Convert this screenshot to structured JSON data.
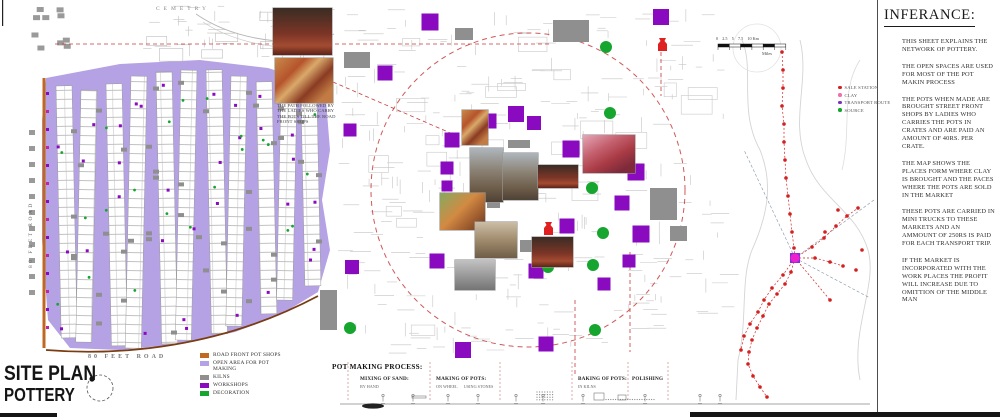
{
  "sheet_title": {
    "line1": "SITE PLAN",
    "line2": "POTTERY"
  },
  "labels": {
    "cemetery": "CEMETRY",
    "road_vertical": "80 FEET ROAD",
    "road_bottom": "80 FEET ROAD"
  },
  "site_legend": [
    {
      "label": "ROAD FRONT POT SHOPS",
      "color": "#c06820"
    },
    {
      "label": "OPEN AREA FOR POT MAKING",
      "color": "#b4a2e4"
    },
    {
      "label": "KILNS",
      "color": "#8f8f8f"
    },
    {
      "label": "WORKSHOPS",
      "color": "#8a0bbf"
    },
    {
      "label": "DECORATION",
      "color": "#16a52e"
    }
  ],
  "photo_caption": "THE PATH FOLLOWED BY THE LADIES WHO CARRY THE POTS TILL THE ROAD FRONT SHOPS",
  "process": {
    "title": "POT MAKING PROCESS:",
    "stages": [
      {
        "label": "MIXING OF SAND:",
        "subs": [
          "BY HAND"
        ],
        "x": 360
      },
      {
        "label": "MAKING OF POTS:",
        "subs": [
          "ON WHEEL",
          "USING STONES"
        ],
        "x": 436
      },
      {
        "label": "BAKING OF POTS:",
        "subs": [
          "IN KILNS"
        ],
        "x": 578
      },
      {
        "label": "POLISHING",
        "subs": [],
        "x": 632
      }
    ]
  },
  "network": {
    "legend": [
      {
        "label": "SALE STATION",
        "color": "#d42020"
      },
      {
        "label": "CLAY",
        "color": "#f06eaa"
      },
      {
        "label": "TRANSPORT ROUTE",
        "color": "#7d2fc0"
      },
      {
        "label": "SOURCE",
        "color": "#16a52e"
      }
    ],
    "scale_top": "0    2.5    5    7.5    10 Km",
    "scale_bottom": "Miles"
  },
  "inference": {
    "title": "INFERANCE:",
    "paragraphs": [
      "THIS SHEET EXPLAINS THE NETWORK OF POTTERY.",
      "THE OPEN SPACES ARE USED FOR MOST OF THE POT MAKIN PROCESS",
      "THE POTS WHEN MADE ARE BROUGHT STREET FRONT SHOPS BY LADIES WHO CARRIES THE POTS IN CRATES AND ARE PAID AN AMOUNT OF 40RS. PER CRATE.",
      "THE MAP SHOWS THE PLACES FORM WHERE CLAY IS BROUGHT AND THE PACES WHERE THE POTS ARE SOLD IN THE MARKET",
      "THESE POTS ARE CARRIED IN MINI TRUCKS TO THESE MARKETS AND AN AMMOUNT OF 250RS IS PAID FOR EACH TRANSPORT TRIP.",
      "IF THE MARKET IS INCORPORATED WITH THE WORK PLACES THE PROFIT WILL INCREASE DUE TO OMITTION OF THE MIDDLE MAN"
    ]
  },
  "map_markers": {
    "workshops": [
      [
        661,
        17,
        16
      ],
      [
        430,
        22,
        17
      ],
      [
        385,
        73,
        15
      ],
      [
        350,
        130,
        13
      ],
      [
        489,
        121,
        15
      ],
      [
        516,
        114,
        16
      ],
      [
        534,
        123,
        14
      ],
      [
        452,
        140,
        15
      ],
      [
        447,
        168,
        13
      ],
      [
        447,
        186,
        11
      ],
      [
        571,
        149,
        17
      ],
      [
        544,
        173,
        14
      ],
      [
        636,
        172,
        17
      ],
      [
        622,
        203,
        15
      ],
      [
        567,
        226,
        15
      ],
      [
        641,
        234,
        17
      ],
      [
        437,
        261,
        15
      ],
      [
        536,
        271,
        15
      ],
      [
        629,
        261,
        13
      ],
      [
        352,
        267,
        14
      ],
      [
        463,
        350,
        16
      ],
      [
        546,
        344,
        15
      ],
      [
        604,
        284,
        13
      ]
    ],
    "decoration": [
      [
        606,
        47
      ],
      [
        610,
        113
      ],
      [
        591,
        156
      ],
      [
        592,
        188
      ],
      [
        603,
        233
      ],
      [
        593,
        265
      ],
      [
        548,
        267
      ],
      [
        595,
        330
      ],
      [
        350,
        328
      ]
    ],
    "kilns": [
      [
        553,
        20,
        36,
        22
      ],
      [
        344,
        52,
        26,
        16
      ],
      [
        455,
        28,
        18,
        12
      ],
      [
        508,
        140,
        22,
        8
      ],
      [
        487,
        200,
        13,
        8
      ],
      [
        520,
        240,
        13,
        12
      ],
      [
        650,
        188,
        27,
        32
      ],
      [
        670,
        226,
        17,
        15
      ],
      [
        320,
        290,
        17,
        40
      ]
    ],
    "pot_icons": [
      [
        657,
        38
      ],
      [
        543,
        222
      ]
    ],
    "network_chains": [
      [
        [
          782,
          52
        ],
        [
          783,
          70
        ],
        [
          783,
          88
        ],
        [
          782,
          106
        ],
        [
          784,
          124
        ],
        [
          784,
          142
        ],
        [
          785,
          160
        ],
        [
          786,
          178
        ],
        [
          788,
          196
        ],
        [
          790,
          214
        ],
        [
          792,
          232
        ],
        [
          794,
          248
        ],
        [
          795,
          258
        ]
      ],
      [
        [
          795,
          258
        ],
        [
          791,
          272
        ],
        [
          785,
          284
        ],
        [
          777,
          294
        ],
        [
          769,
          304
        ],
        [
          763,
          316
        ],
        [
          757,
          328
        ],
        [
          752,
          340
        ],
        [
          749,
          352
        ],
        [
          748,
          364
        ],
        [
          753,
          376
        ],
        [
          760,
          387
        ],
        [
          767,
          397
        ]
      ],
      [
        [
          795,
          258
        ],
        [
          783,
          275
        ],
        [
          772,
          288
        ],
        [
          764,
          300
        ],
        [
          758,
          312
        ],
        [
          750,
          324
        ],
        [
          744,
          336
        ],
        [
          741,
          350
        ]
      ],
      [
        [
          795,
          258
        ],
        [
          812,
          247
        ],
        [
          824,
          238
        ],
        [
          836,
          226
        ],
        [
          847,
          216
        ],
        [
          858,
          208
        ]
      ],
      [
        [
          795,
          258
        ],
        [
          815,
          258
        ],
        [
          830,
          262
        ],
        [
          843,
          266
        ]
      ],
      [
        [
          795,
          258
        ],
        [
          830,
          300
        ]
      ]
    ],
    "network_extra_dots": [
      [
        838,
        210
      ],
      [
        825,
        232
      ],
      [
        856,
        270
      ],
      [
        862,
        250
      ]
    ],
    "hub": [
      795,
      258
    ]
  },
  "photos": [
    {
      "x": 273,
      "y": 8,
      "w": 59,
      "h": 47,
      "pal": "p3"
    },
    {
      "x": 275,
      "y": 58,
      "w": 58,
      "h": 45,
      "pal": "p1"
    },
    {
      "x": 462,
      "y": 110,
      "w": 26,
      "h": 35,
      "pal": "p1"
    },
    {
      "x": 470,
      "y": 148,
      "w": 33,
      "h": 54,
      "pal": "p2"
    },
    {
      "x": 503,
      "y": 153,
      "w": 35,
      "h": 47,
      "pal": "p2"
    },
    {
      "x": 538,
      "y": 165,
      "w": 40,
      "h": 23,
      "pal": "p3"
    },
    {
      "x": 583,
      "y": 135,
      "w": 52,
      "h": 38,
      "pal": "p4"
    },
    {
      "x": 440,
      "y": 193,
      "w": 45,
      "h": 37,
      "pal": "p7"
    },
    {
      "x": 475,
      "y": 222,
      "w": 42,
      "h": 36,
      "pal": "p5"
    },
    {
      "x": 532,
      "y": 237,
      "w": 41,
      "h": 30,
      "pal": "p3"
    },
    {
      "x": 455,
      "y": 260,
      "w": 40,
      "h": 30,
      "pal": "p6"
    }
  ]
}
